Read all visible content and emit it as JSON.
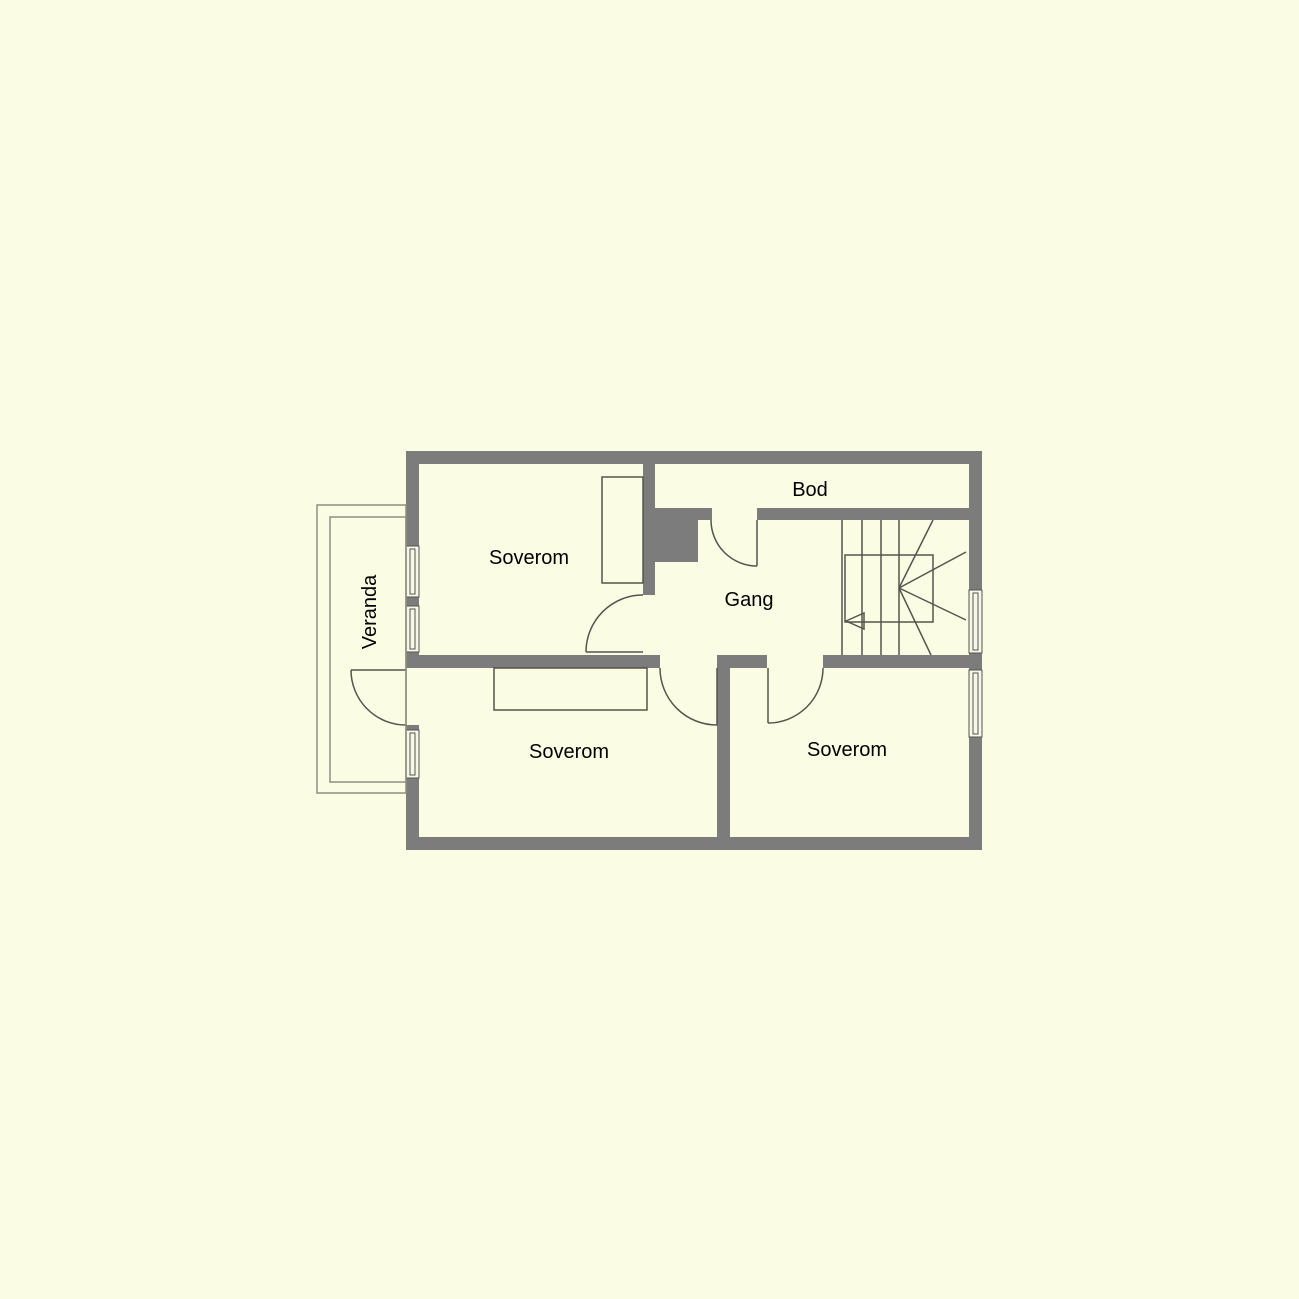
{
  "plan": {
    "labels": {
      "bedroom_nw": "Soverom",
      "storage": "Bod",
      "hallway": "Gang",
      "bedroom_sw": "Soverom",
      "bedroom_se": "Soverom",
      "veranda": "Veranda"
    },
    "colors": {
      "background": "#fbfce4",
      "wall": "#7c7c7c",
      "line": "#55544d",
      "glass": "#f6f7e8",
      "veranda_line": "#8e8e7e",
      "text": "#000000"
    }
  }
}
